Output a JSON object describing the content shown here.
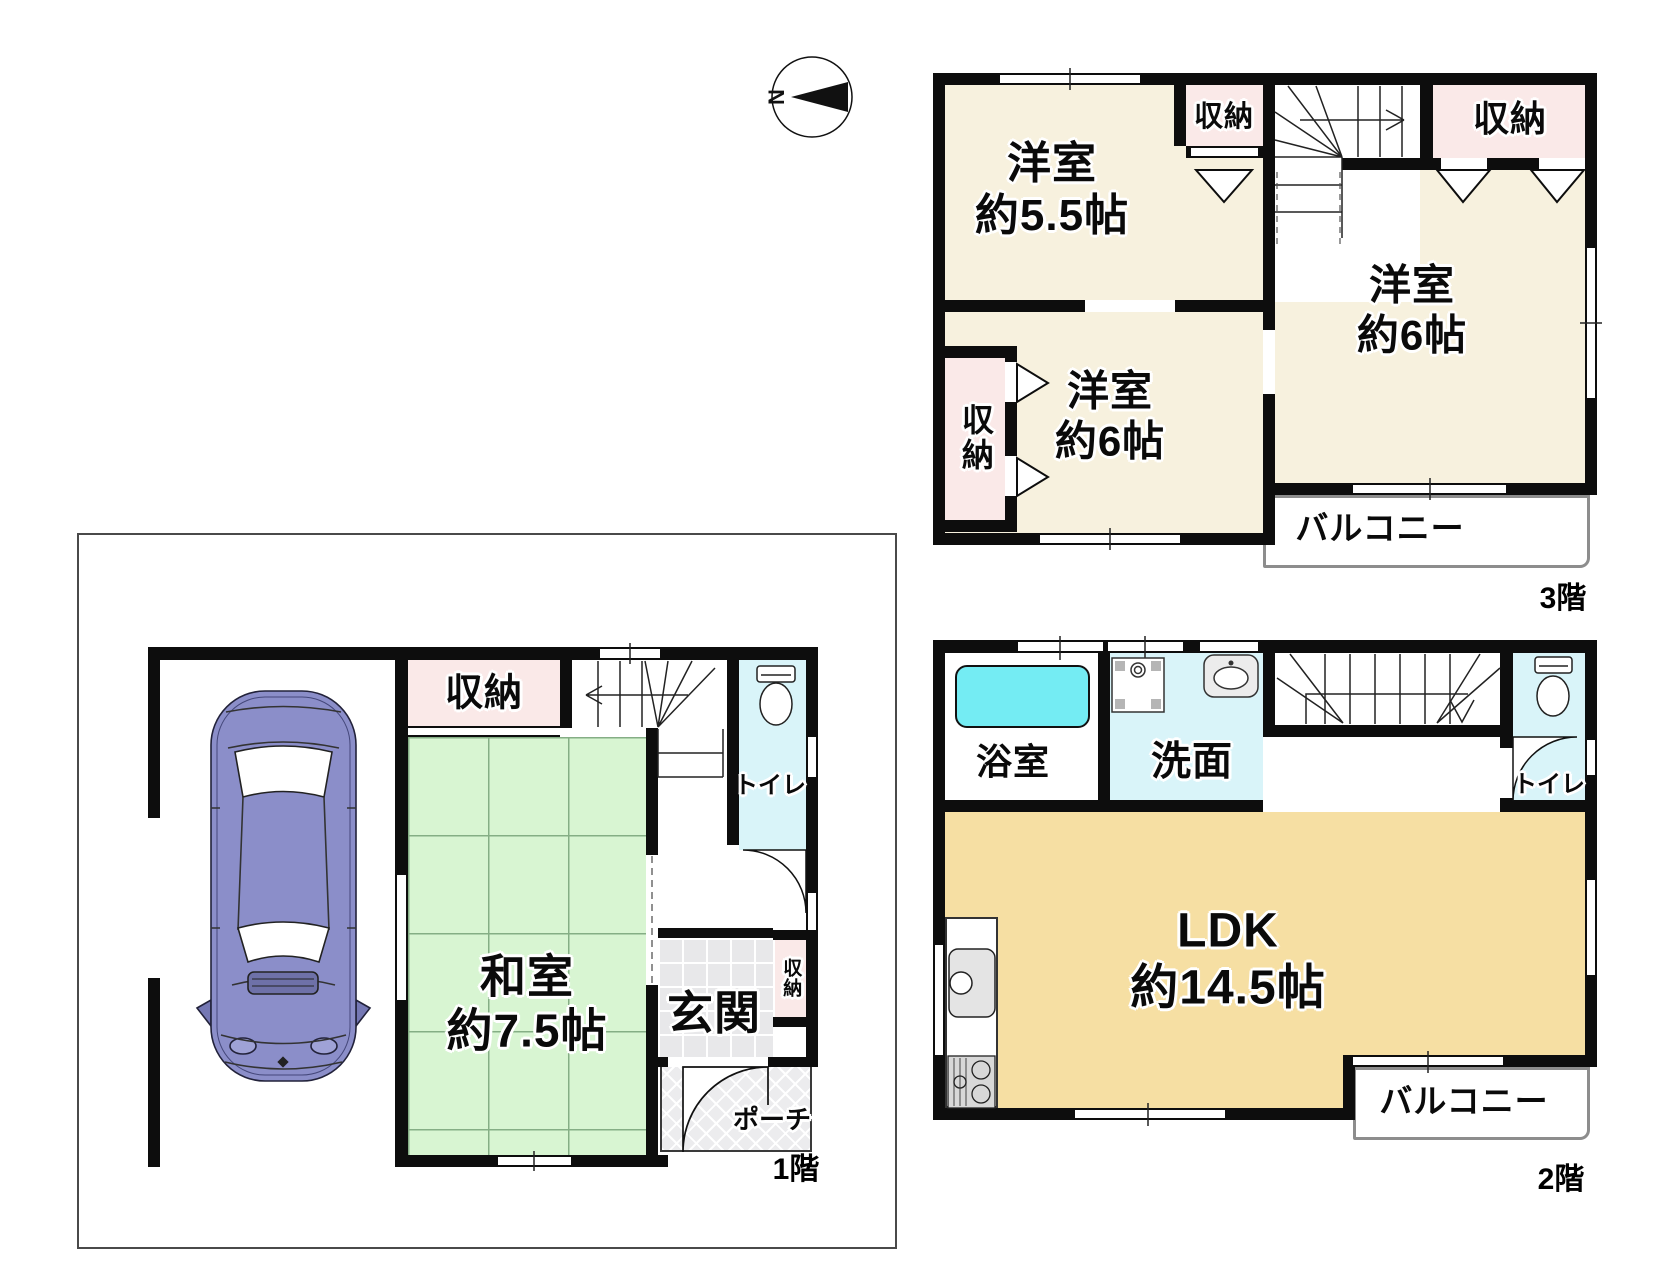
{
  "compass": {
    "north": "N"
  },
  "floor1": {
    "label": "1階",
    "washitsu": "和室\n約7.5帖",
    "storage": "収納",
    "entrance": "玄関",
    "entrance_storage": "収納",
    "toilet": "トイレ",
    "porch": "ポーチ"
  },
  "floor2": {
    "label": "2階",
    "ldk": "LDK\n約14.5帖",
    "bathroom": "浴室",
    "washroom": "洗面",
    "toilet": "トイレ",
    "balcony": "バルコニー"
  },
  "floor3": {
    "label": "3階",
    "bedroom_a": "洋室\n約5.5帖",
    "bedroom_b": "洋室\n約6帖",
    "bedroom_c": "洋室\n約6帖",
    "storage_a": "収納",
    "storage_b": "収納",
    "storage_c": "収納",
    "balcony": "バルコニー"
  },
  "colors": {
    "wall": "#0d0d0d",
    "western_room": "#f7f1de",
    "closet": "#fae9e8",
    "tatami": "#d8f5d2",
    "ldk": "#f6dfa3",
    "wet_room": "#d9f4f9",
    "bathtub": "#74ecf3",
    "car_body": "#8b8ec9"
  }
}
